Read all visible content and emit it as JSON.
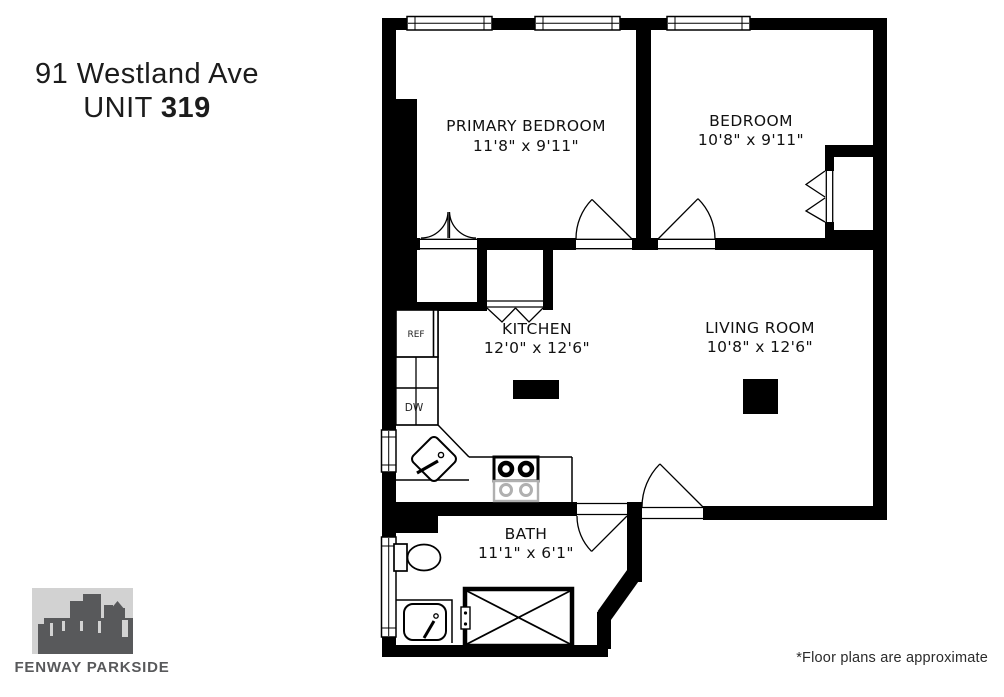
{
  "title": {
    "address": "91 Westland Ave",
    "unit_prefix": "UNIT ",
    "unit_number": "319"
  },
  "rooms": {
    "primary_bedroom": {
      "name": "PRIMARY BEDROOM",
      "dims": "11'8\" x 9'11\""
    },
    "bedroom": {
      "name": "BEDROOM",
      "dims": "10'8\" x 9'11\""
    },
    "kitchen": {
      "name": "KITCHEN",
      "dims": "12'0\" x 12'6\""
    },
    "living_room": {
      "name": "LIVING ROOM",
      "dims": "10'8\" x 12'6\""
    },
    "bath": {
      "name": "BATH",
      "dims": "11'1\" x 6'1\""
    }
  },
  "appliances": {
    "refrigerator": "REF",
    "dishwasher": "DW"
  },
  "logo": {
    "text": "FENWAY PARKSIDE"
  },
  "footer": {
    "disclaimer": "*Floor plans are approximate"
  },
  "colors": {
    "walls": "#000000",
    "label_text": "#111111",
    "logo_dark": "#58595b",
    "logo_light": "#d2d2d2",
    "stove_gray": "#b0b0b0"
  }
}
